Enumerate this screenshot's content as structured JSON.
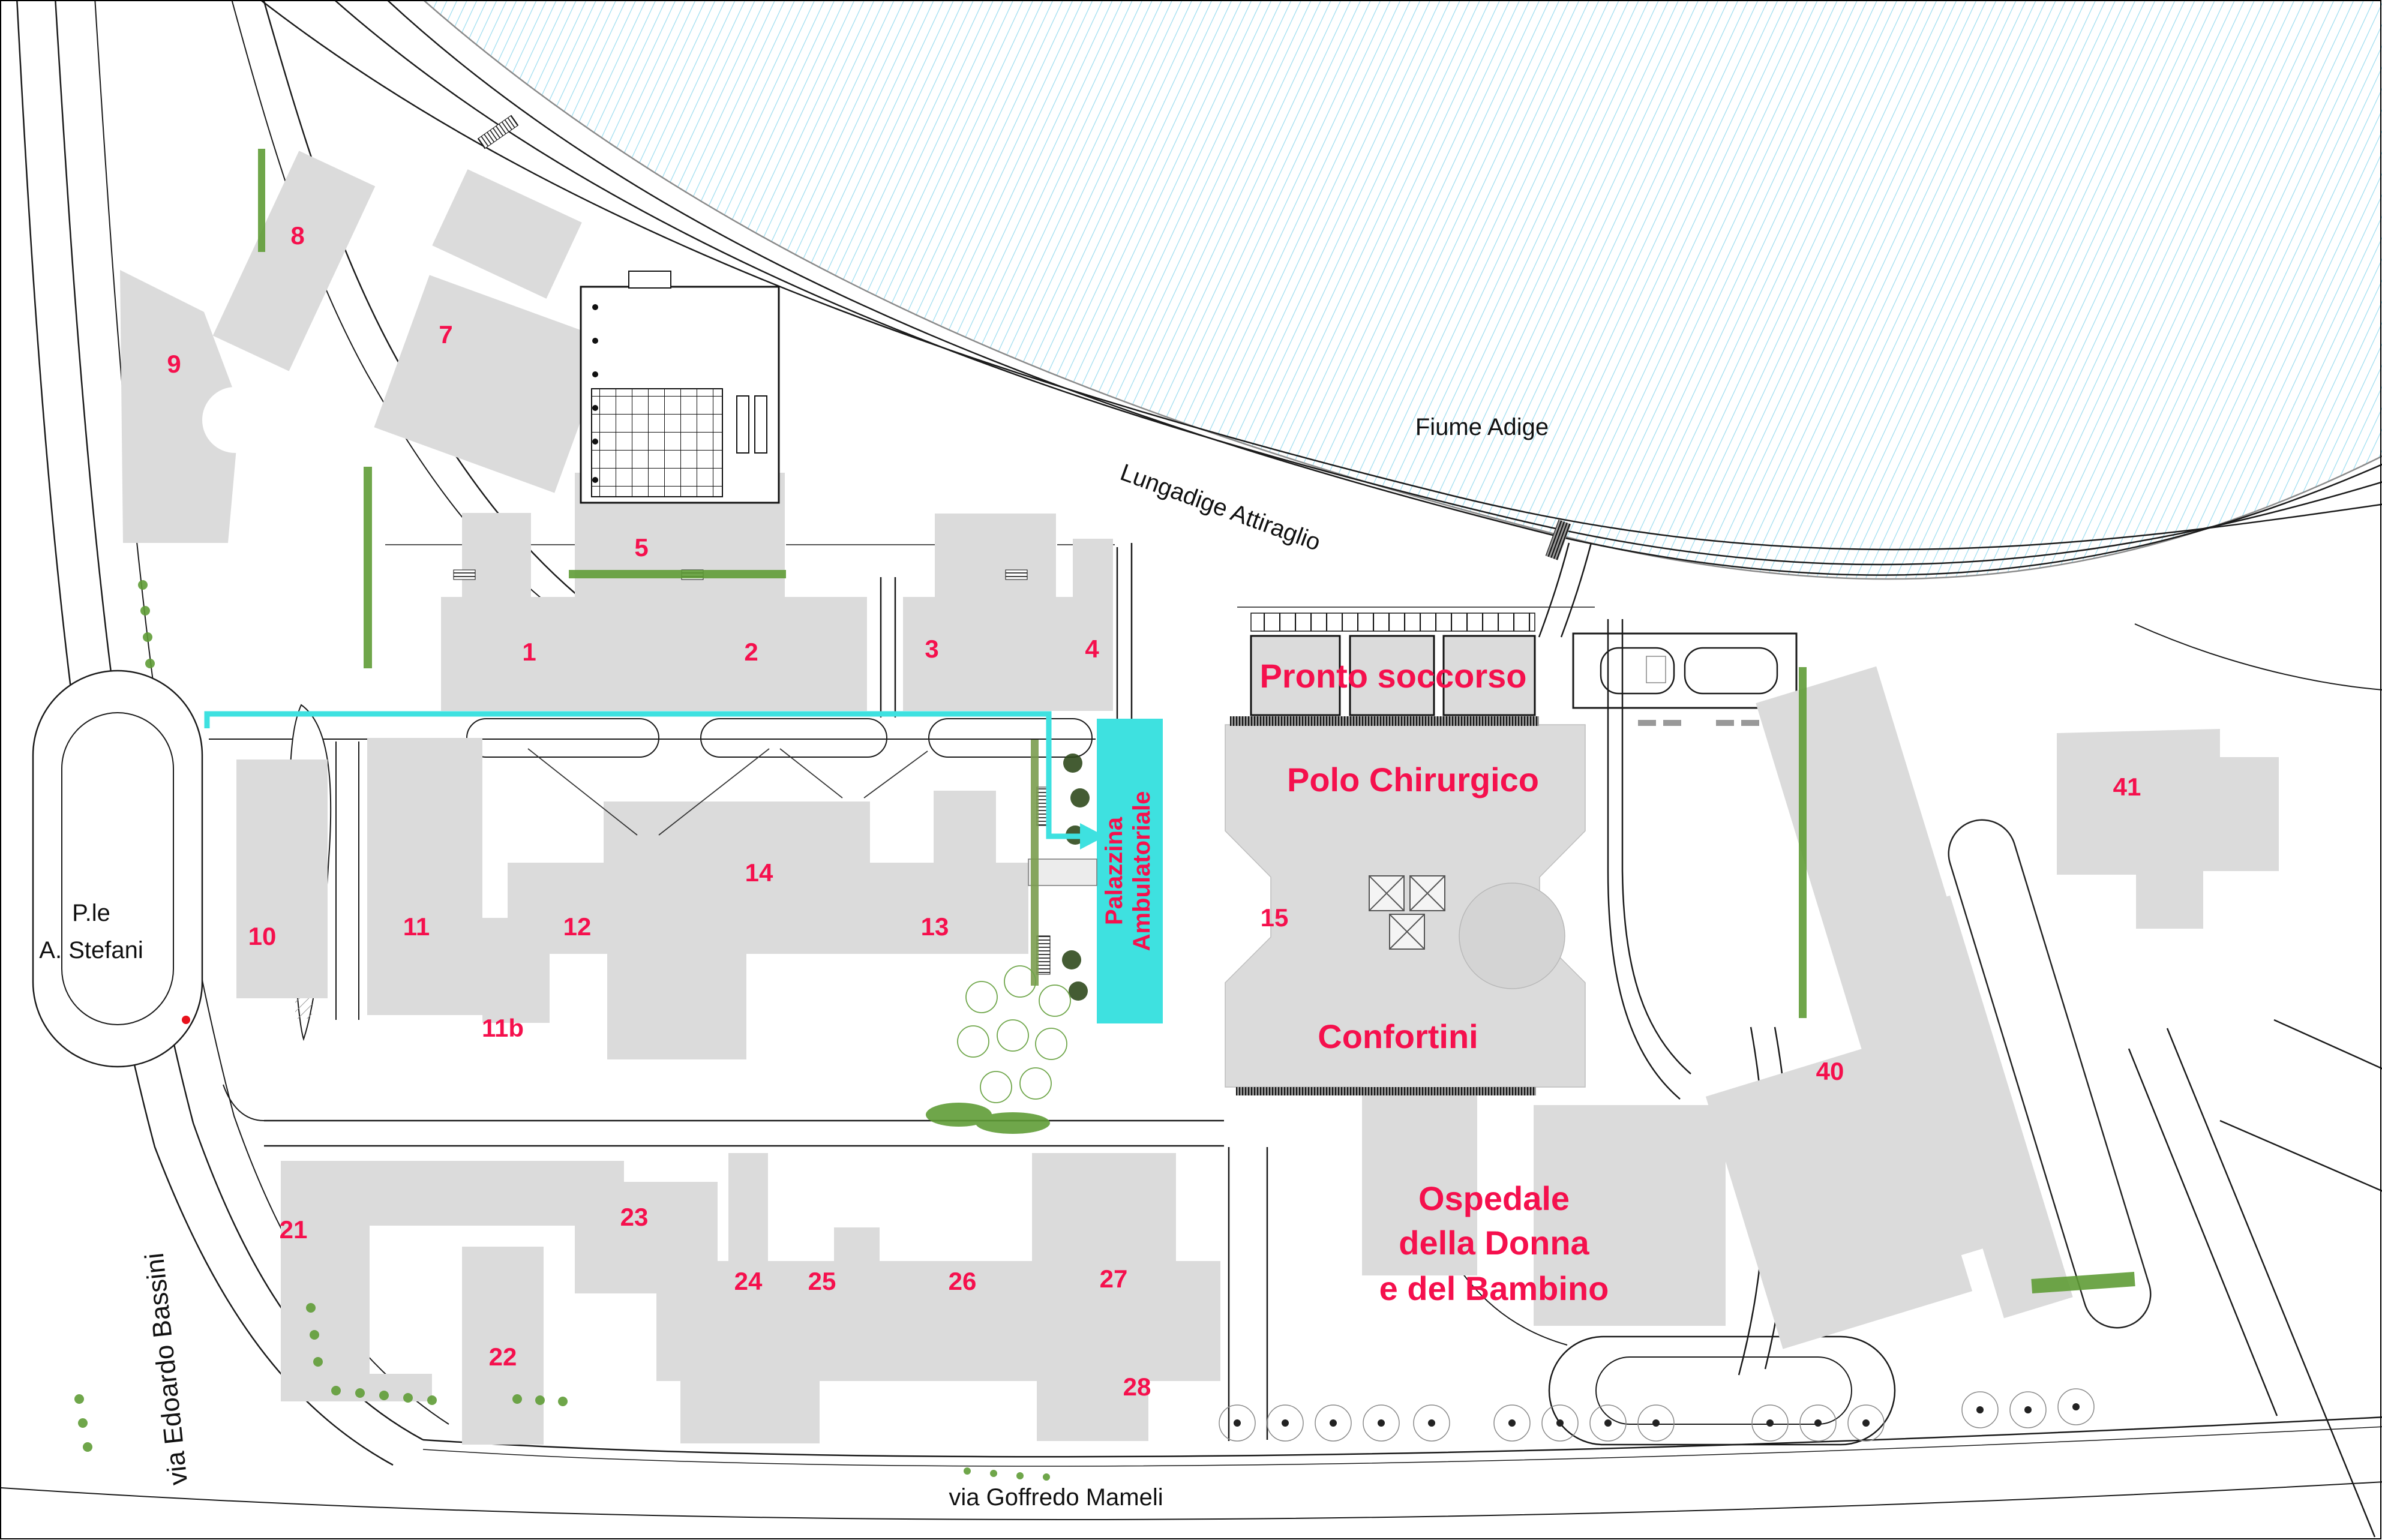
{
  "map": {
    "water": {
      "river_label": "Fiume Adige"
    },
    "roads": {
      "lungadige": "Lungadige Attiraglio",
      "bassini": "via Edoardo Bassini",
      "mameli": "via Goffredo Mameli",
      "stefani_line1": "P.le",
      "stefani_line2": "A. Stefani"
    },
    "areas": {
      "pronto": "Pronto soccorso",
      "polo": "Polo Chirurgico",
      "confortini": "Confortini",
      "ospedale_line1": "Ospedale",
      "ospedale_line2": "della Donna",
      "ospedale_line3": "e del Bambino",
      "palazzina_line1": "Palazzina",
      "palazzina_line2": "Ambulatoriale"
    },
    "building_numbers": [
      "1",
      "2",
      "3",
      "4",
      "5",
      "7",
      "8",
      "9",
      "10",
      "11",
      "11b",
      "12",
      "13",
      "14",
      "15",
      "21",
      "22",
      "23",
      "24",
      "25",
      "26",
      "27",
      "28",
      "40",
      "41"
    ],
    "colors": {
      "pink": "#F5104D",
      "cyan": "#3EE1E0",
      "gray": "#DBDBDB",
      "gray_dark": "#C4C4C4",
      "line": "#1A1A1A",
      "river": "#9BDCEF",
      "green": "#5F9C36",
      "green_dark": "#2F4A1C",
      "red": "#E8111C"
    }
  }
}
